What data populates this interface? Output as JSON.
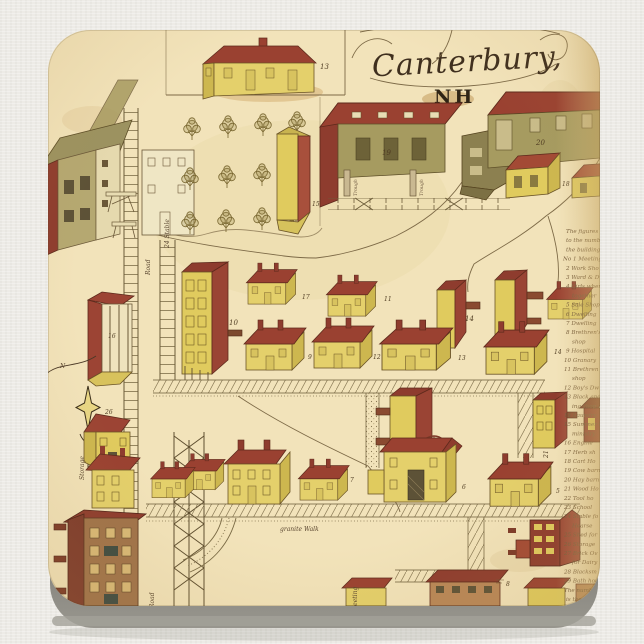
{
  "product": {
    "background_color": "#edebe6",
    "coaster_edge_color": "#63615c",
    "paper_color": "#f2e3ba"
  },
  "map": {
    "title": "Canterbury,",
    "state": "NH",
    "labels": {
      "granite_walk": "granite Walk",
      "stable24": "24 Stable",
      "road_upper": "Road",
      "road_lower": "Road",
      "storage": "Storage",
      "meeting": "Meeting",
      "trough_1": "Trough",
      "trough_2": "Trough",
      "compass_north": "N"
    },
    "numbers": {
      "b13_top": "13",
      "b15": "15",
      "b19": "19",
      "b20": "20",
      "b18": "18",
      "b10": "10",
      "b17": "17",
      "b11": "11",
      "b14_towers": "14",
      "b9": "9",
      "b12": "12",
      "b13_row": "13",
      "b14_row": "14",
      "b16": "16",
      "b26": "26",
      "b21": "21",
      "b6": "6",
      "b5": "5",
      "b7": "7",
      "b8_note": "8"
    },
    "legend": {
      "lines": [
        "The figures o",
        "to the number",
        "the buildings",
        "No 1 Meeting h",
        "2 Work Sho",
        "3 Ward & Dw",
        "4 Girls wher",
        "together",
        "5 Sale Shop",
        "6 Dwelling",
        "7 Dwelling",
        "8 Brethren's",
        "shop",
        "9 Hospital",
        "10 Granary",
        "11 Brethren",
        "shop",
        "12 Boy's Dw",
        "13 Black and",
        "ing shop",
        "14 Laundry",
        "15 Summer h",
        "ministry",
        "16 Engine",
        "17 Herb sh",
        "18 Cart Ho",
        "19 Cow barn",
        "20 Hay barn",
        "21 Wood Ho",
        "22 Tool ho",
        "23 School",
        "24 Stable fo",
        "Hearse",
        "25 Shed for",
        "26 Storage",
        "27 Brick Ov",
        "for Dairy",
        "28 Blacksm",
        "29 Bath hou",
        "The numbers",
        "is the ag"
      ]
    }
  }
}
